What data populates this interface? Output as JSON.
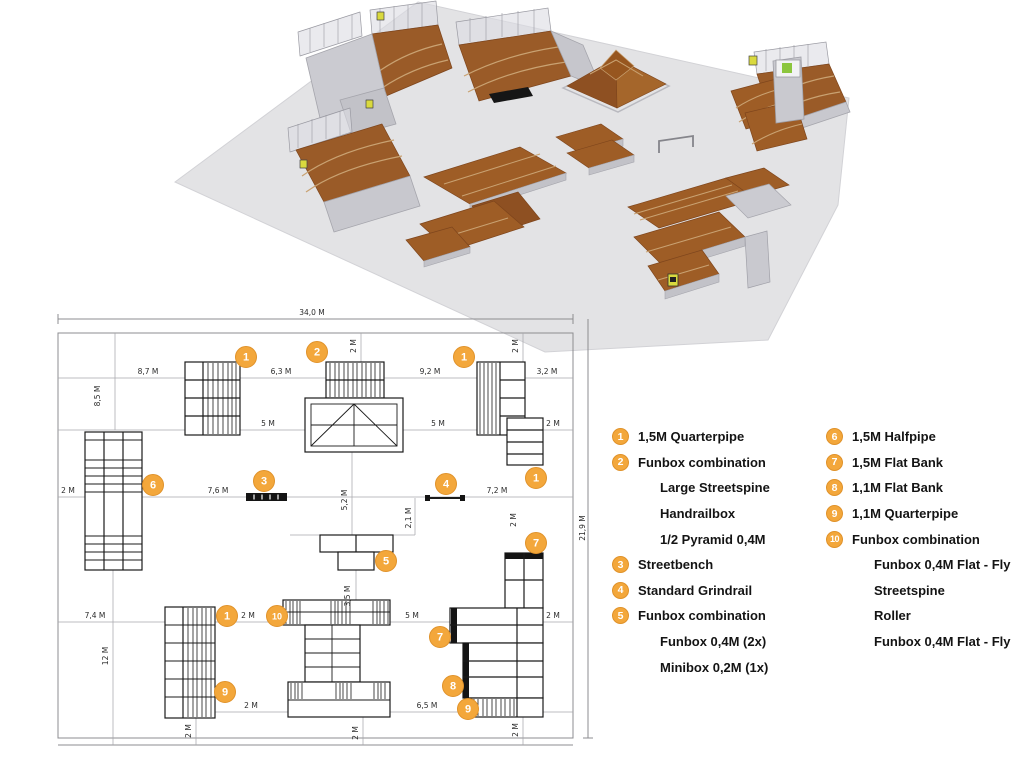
{
  "title": "Skatepark layout sheet",
  "colors": {
    "accent_orange": "#F3A73B",
    "accent_orange_dark": "#E0922A",
    "ramp_brown": "#9E5D26",
    "ramp_brown_dark": "#8E5022",
    "floor_gray": "#E3E3E5",
    "structure_gray": "#C9C9CF",
    "plan_line": "#1B1B1B",
    "dim_line_gray": "#A8A8AC",
    "sign_yellow": "#D9D93E",
    "sign_green": "#8CC63E"
  },
  "legend": {
    "columns": [
      {
        "items": [
          {
            "num": "1",
            "label": "1,5M Quarterpipe"
          },
          {
            "num": "2",
            "label": "Funbox combination"
          },
          {
            "num": null,
            "label": "Large Streetspine"
          },
          {
            "num": null,
            "label": "Handrailbox"
          },
          {
            "num": null,
            "label": "1/2 Pyramid 0,4M"
          },
          {
            "num": "3",
            "label": "Streetbench"
          },
          {
            "num": "4",
            "label": "Standard Grindrail"
          },
          {
            "num": "5",
            "label": "Funbox combination"
          },
          {
            "num": null,
            "label": "Funbox 0,4M (2x)"
          },
          {
            "num": null,
            "label": "Minibox 0,2M (1x)"
          }
        ]
      },
      {
        "items": [
          {
            "num": "6",
            "label": "1,5M Halfpipe"
          },
          {
            "num": "7",
            "label": "1,5M Flat Bank"
          },
          {
            "num": "8",
            "label": "1,1M Flat Bank"
          },
          {
            "num": "9",
            "label": "1,1M Quarterpipe"
          },
          {
            "num": "10",
            "label": "Funbox combination"
          },
          {
            "num": null,
            "label": "Funbox 0,4M Flat - Fly"
          },
          {
            "num": null,
            "label": "Streetspine"
          },
          {
            "num": null,
            "label": "Roller"
          },
          {
            "num": null,
            "label": "Funbox 0,4M Flat - Fly"
          }
        ]
      }
    ]
  },
  "plan": {
    "markers": [
      {
        "num": "1",
        "x": 246,
        "y": 357
      },
      {
        "num": "2",
        "x": 317,
        "y": 352
      },
      {
        "num": "1",
        "x": 464,
        "y": 357
      },
      {
        "num": "1",
        "x": 536,
        "y": 478
      },
      {
        "num": "6",
        "x": 153,
        "y": 485
      },
      {
        "num": "3",
        "x": 264,
        "y": 481
      },
      {
        "num": "4",
        "x": 446,
        "y": 484
      },
      {
        "num": "5",
        "x": 386,
        "y": 561
      },
      {
        "num": "7",
        "x": 536,
        "y": 543
      },
      {
        "num": "1",
        "x": 227,
        "y": 616
      },
      {
        "num": "10",
        "x": 277,
        "y": 616
      },
      {
        "num": "7",
        "x": 440,
        "y": 637
      },
      {
        "num": "8",
        "x": 453,
        "y": 686
      },
      {
        "num": "9",
        "x": 225,
        "y": 692
      },
      {
        "num": "9",
        "x": 468,
        "y": 709
      }
    ],
    "dimensions": [
      {
        "text": "34,0 M",
        "x": 312,
        "y": 315,
        "rot": 0
      },
      {
        "text": "21,9 M",
        "x": 585,
        "y": 528,
        "rot": 90
      },
      {
        "text": "8,7 M",
        "x": 148,
        "y": 374,
        "rot": 0
      },
      {
        "text": "6,3 M",
        "x": 281,
        "y": 374,
        "rot": 0
      },
      {
        "text": "9,2 M",
        "x": 430,
        "y": 374,
        "rot": 0
      },
      {
        "text": "3,2 M",
        "x": 547,
        "y": 374,
        "rot": 0
      },
      {
        "text": "2 M",
        "x": 356,
        "y": 346,
        "rot": 90
      },
      {
        "text": "2 M",
        "x": 518,
        "y": 346,
        "rot": 90
      },
      {
        "text": "8,5 M",
        "x": 100,
        "y": 396,
        "rot": 90
      },
      {
        "text": "5 M",
        "x": 268,
        "y": 426,
        "rot": 0
      },
      {
        "text": "5 M",
        "x": 438,
        "y": 426,
        "rot": 0
      },
      {
        "text": "2 M",
        "x": 553,
        "y": 426,
        "rot": 0
      },
      {
        "text": "2 M",
        "x": 68,
        "y": 493,
        "rot": 0
      },
      {
        "text": "7,6 M",
        "x": 218,
        "y": 493,
        "rot": 0
      },
      {
        "text": "7,2 M",
        "x": 497,
        "y": 493,
        "rot": 0
      },
      {
        "text": "5,2 M",
        "x": 347,
        "y": 500,
        "rot": 90
      },
      {
        "text": "2,1 M",
        "x": 411,
        "y": 518,
        "rot": 90
      },
      {
        "text": "2 M",
        "x": 516,
        "y": 520,
        "rot": 90
      },
      {
        "text": "3,5 M",
        "x": 350,
        "y": 596,
        "rot": 90
      },
      {
        "text": "7,4 M",
        "x": 95,
        "y": 618,
        "rot": 0
      },
      {
        "text": "2 M",
        "x": 248,
        "y": 618,
        "rot": 0
      },
      {
        "text": "5 M",
        "x": 412,
        "y": 618,
        "rot": 0
      },
      {
        "text": "2 M",
        "x": 553,
        "y": 618,
        "rot": 0
      },
      {
        "text": "12 M",
        "x": 108,
        "y": 656,
        "rot": 90
      },
      {
        "text": "2 M",
        "x": 251,
        "y": 708,
        "rot": 0
      },
      {
        "text": "6,5 M",
        "x": 427,
        "y": 708,
        "rot": 0
      },
      {
        "text": "2 M",
        "x": 191,
        "y": 731,
        "rot": 90
      },
      {
        "text": "2 M",
        "x": 358,
        "y": 733,
        "rot": 90
      },
      {
        "text": "2 M",
        "x": 518,
        "y": 730,
        "rot": 90
      }
    ]
  }
}
